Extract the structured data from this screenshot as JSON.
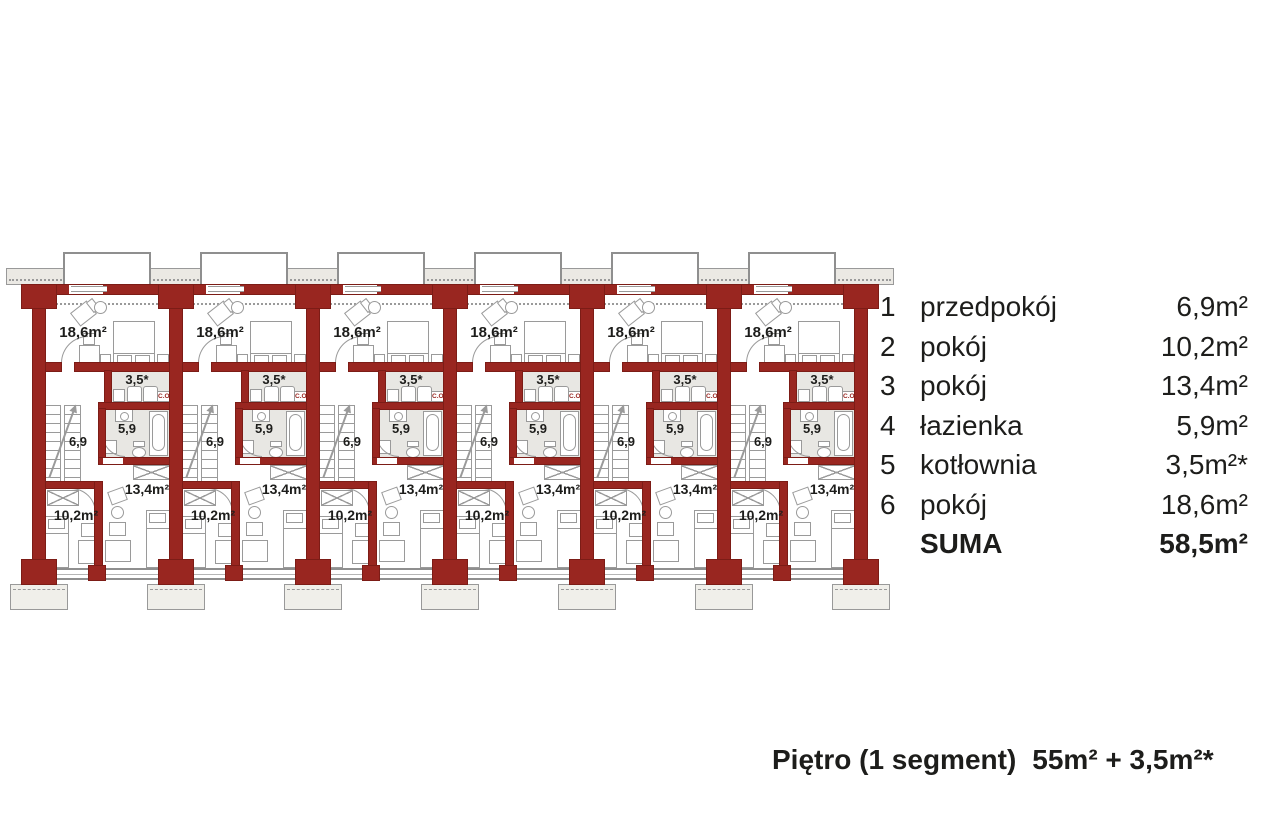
{
  "legend": {
    "rows": [
      {
        "num": "1",
        "name": "przedpokój",
        "area": "6,9m²"
      },
      {
        "num": "2",
        "name": "pokój",
        "area": "10,2m²"
      },
      {
        "num": "3",
        "name": "pokój",
        "area": "13,4m²"
      },
      {
        "num": "4",
        "name": "łazienka",
        "area": "5,9m²"
      },
      {
        "num": "5",
        "name": "kotłownia",
        "area": "3,5m²*"
      },
      {
        "num": "6",
        "name": "pokój",
        "area": "18,6m²"
      },
      {
        "num": "",
        "name": "SUMA",
        "area": "58,5m²"
      }
    ]
  },
  "footer": {
    "label": "Piętro (1 segment)",
    "value": "55m² + 3,5m²*"
  },
  "plan": {
    "segment_count": 6,
    "labels": {
      "room_big": "18,6m²",
      "boiler": "3,5*",
      "bath": "5,9",
      "hall": "6,9",
      "room_small": "10,2m²",
      "room_mid": "13,4m²",
      "co": "C.O."
    },
    "colors": {
      "wall": "#992620",
      "furniture": "#8f8f8f",
      "floor": "#e8e7e3",
      "text": "#1d1d1b"
    }
  }
}
